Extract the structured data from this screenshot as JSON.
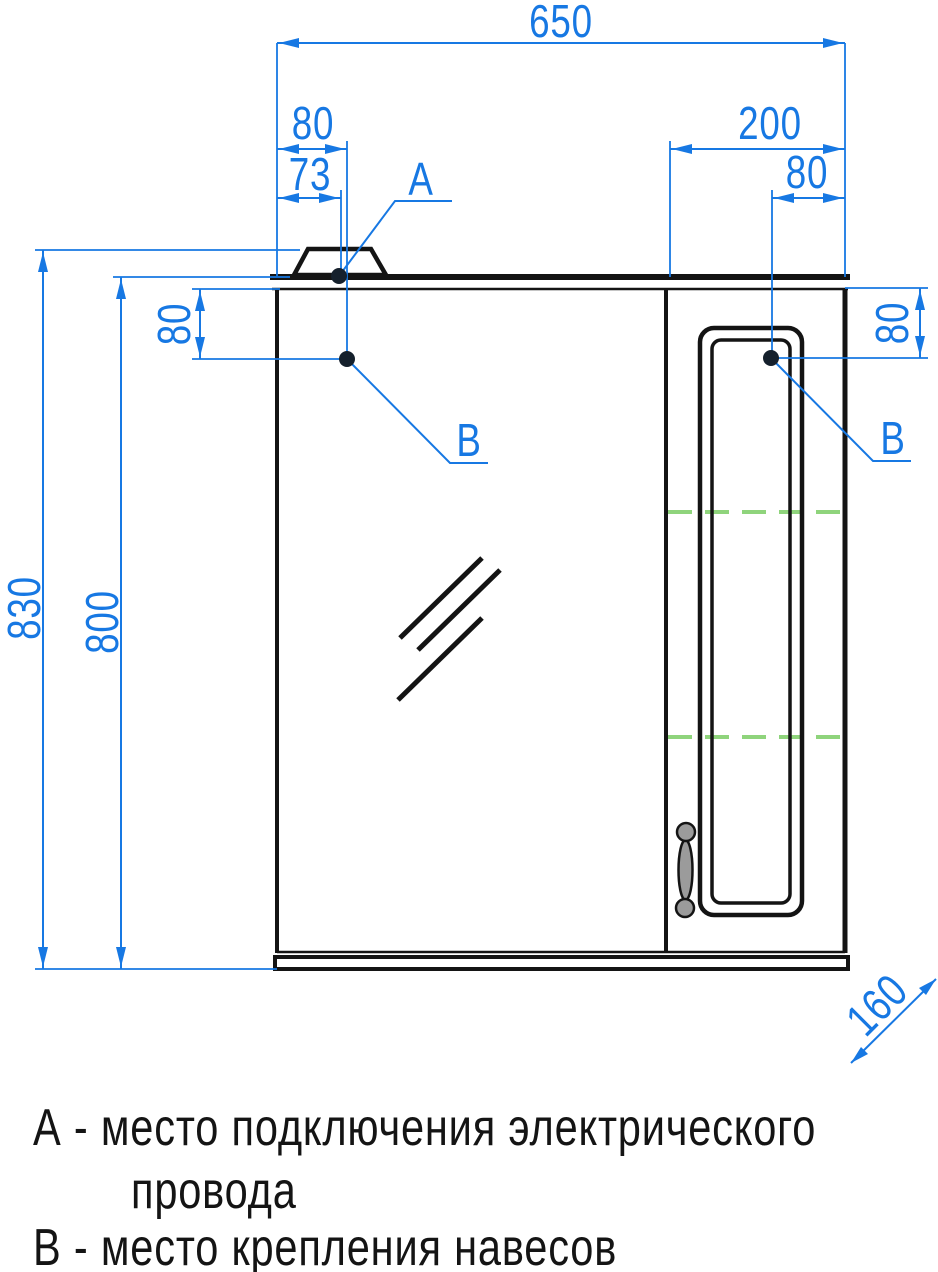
{
  "drawing": {
    "dims": {
      "total_width": "650",
      "left_hinge_offset": "80",
      "left_cable_offset": "73",
      "right_section_width": "200",
      "right_hinge_offset": "80",
      "total_height": "830",
      "body_height": "800",
      "left_hinge_drop": "80",
      "right_hinge_drop": "80",
      "depth": "160"
    },
    "points": {
      "a_label": "А",
      "b_left_label": "В",
      "b_right_label": "В"
    },
    "legend": {
      "line1": "А - место подключения электрического",
      "line2": "провода",
      "line3": "В - место крепления навесов"
    },
    "colors": {
      "dimension": "#1778E3",
      "outline": "#141414",
      "shelf": "#8FD47C",
      "handle_fill": "#9B9B9B",
      "point_fill": "#15202C"
    }
  }
}
